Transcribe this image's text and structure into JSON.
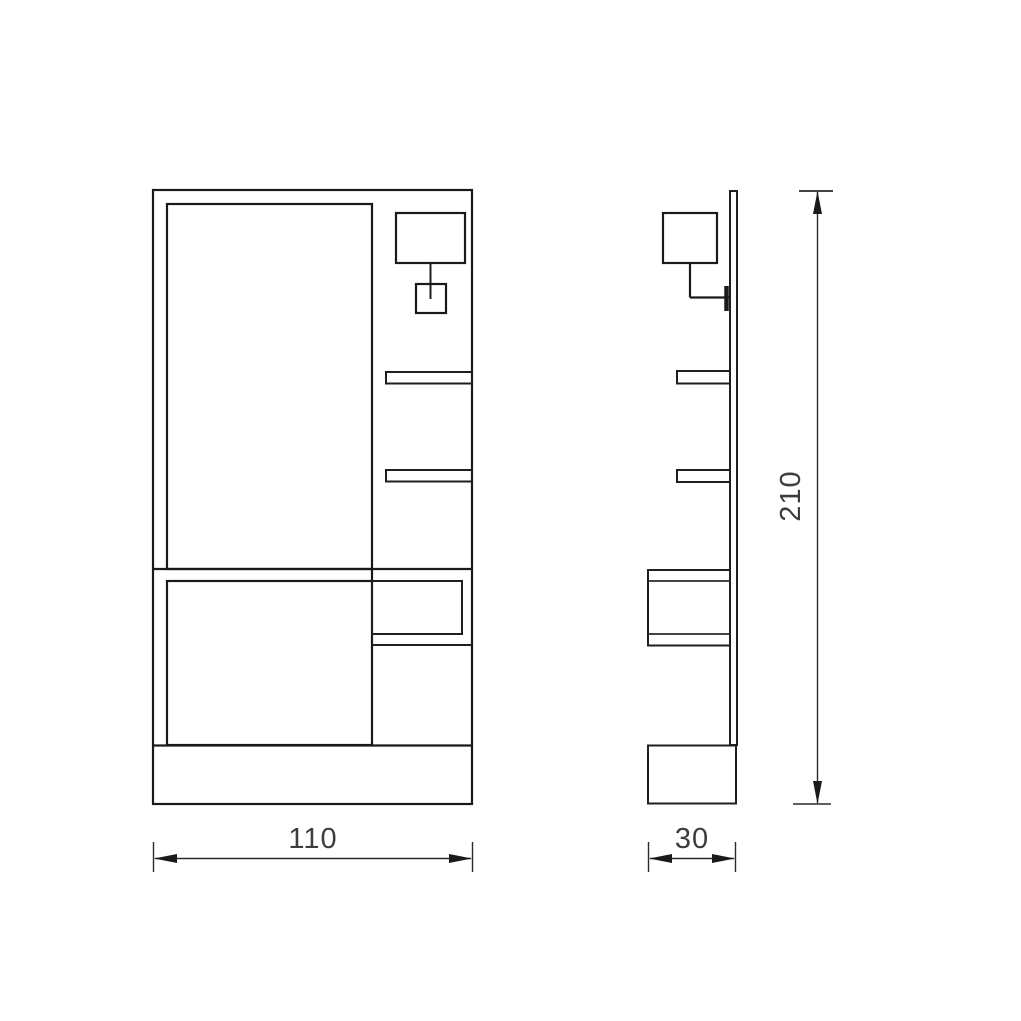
{
  "drawing": {
    "background": "#ffffff",
    "line_color": "#1a1a1a",
    "text_color": "#3d3d3d",
    "dimensions": {
      "width_label": "110",
      "depth_label": "30",
      "height_label": "210"
    }
  }
}
